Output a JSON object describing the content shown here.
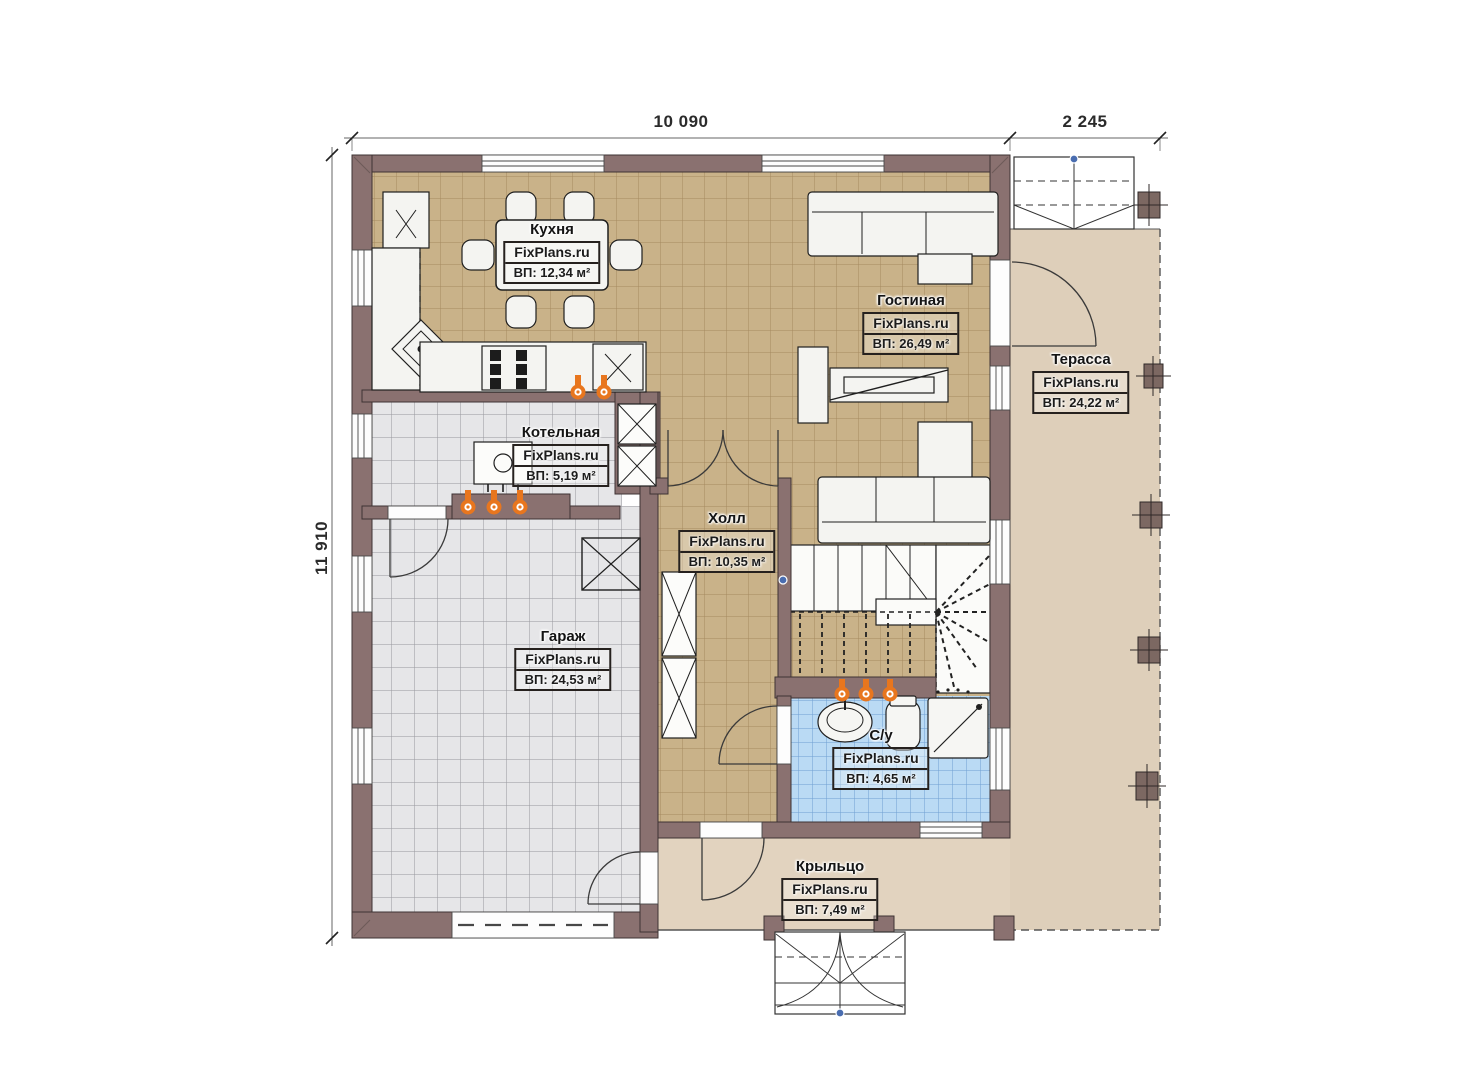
{
  "dimensions": {
    "width_main": "10 090",
    "width_terrace": "2 245",
    "height_left": "11 910"
  },
  "rooms": [
    {
      "key": "kitchen",
      "name": "Кухня",
      "brand": "FixPlans.ru",
      "area": "ВП: 12,34 м²"
    },
    {
      "key": "living",
      "name": "Гостиная",
      "brand": "FixPlans.ru",
      "area": "ВП: 26,49 м²"
    },
    {
      "key": "terrace",
      "name": "Терасса",
      "brand": "FixPlans.ru",
      "area": "ВП: 24,22 м²"
    },
    {
      "key": "boiler",
      "name": "Котельная",
      "brand": "FixPlans.ru",
      "area": "ВП: 5,19 м²"
    },
    {
      "key": "hall",
      "name": "Холл",
      "brand": "FixPlans.ru",
      "area": "ВП: 10,35 м²"
    },
    {
      "key": "garage",
      "name": "Гараж",
      "brand": "FixPlans.ru",
      "area": "ВП: 24,53 м²"
    },
    {
      "key": "bathroom",
      "name": "С/у",
      "brand": "FixPlans.ru",
      "area": "ВП: 4,65 м²"
    },
    {
      "key": "porch",
      "name": "Крыльцо",
      "brand": "FixPlans.ru",
      "area": "ВП: 7,49 м²"
    }
  ],
  "colors": {
    "wall": "#8a7170",
    "floor_tan": "#c9b289",
    "floor_gray": "#e6e6e8",
    "floor_blue": "#badaf4",
    "terrace": "#decfba",
    "porch": "#e2d3bf",
    "marker_orange": "#e8761e"
  }
}
